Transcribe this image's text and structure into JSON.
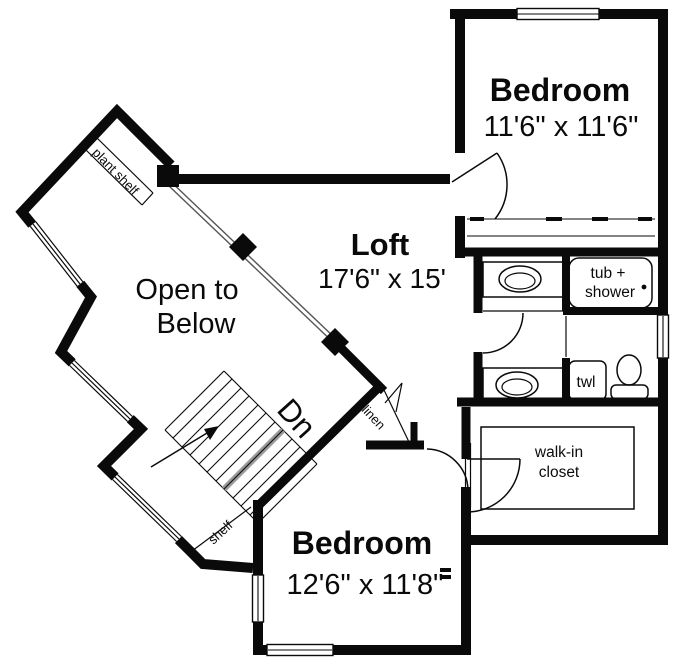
{
  "colors": {
    "wall": "#0a0a0a",
    "background": "#ffffff",
    "railing": "#555555",
    "stair_band": "#9a9a9a"
  },
  "rooms": {
    "bedroom_upper": {
      "name": "Bedroom",
      "dimensions": "11'6\" x 11'6\""
    },
    "loft": {
      "name": "Loft",
      "dimensions": "17'6\" x 15'"
    },
    "open_to_below": {
      "line1": "Open to",
      "line2": "Below"
    },
    "bedroom_lower": {
      "name": "Bedroom",
      "dimensions": "12'6\" x 11'8\""
    }
  },
  "features": {
    "tub_shower": {
      "line1": "tub +",
      "line2": "shower"
    },
    "towel": "twl",
    "walk_in_closet": {
      "line1": "walk-in",
      "line2": "closet"
    },
    "linen": "linen",
    "stairs_direction": "Dn",
    "plant_shelf": "plant shelf",
    "shelf": "shelf"
  }
}
